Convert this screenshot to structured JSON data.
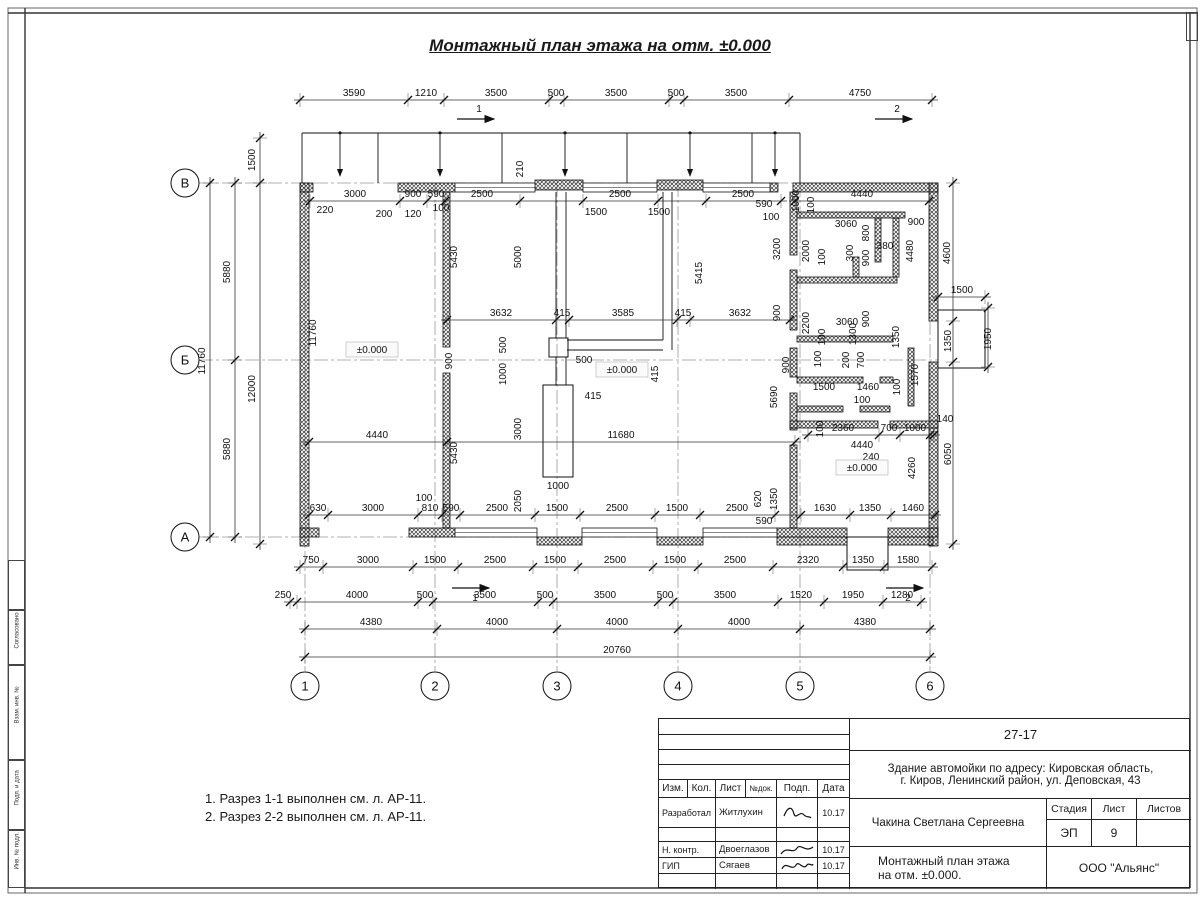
{
  "title": "Монтажный план этажа на отм. ±0.000",
  "notes": [
    "1. Разрез 1-1 выполнен см. л. АР-11.",
    "2. Разрез 2-2 выполнен см. л. АР-11."
  ],
  "title_block": {
    "doc_number": "27-17",
    "project_line1": "Здание автомойки по адресу: Кировская область,",
    "project_line2": "г. Киров, Ленинский район, ул. Деповская, 43",
    "columns": [
      "Изм.",
      "Кол.",
      "Лист",
      "№док.",
      "Подп.",
      "Дата"
    ],
    "rows": [
      {
        "role": "Разработал",
        "name": "Житлухин",
        "date": "10.17"
      },
      {
        "role": "Н. контр.",
        "name": "Двоеглазов",
        "date": "10.17"
      },
      {
        "role": "ГИП",
        "name": "Сягаев",
        "date": "10.17"
      }
    ],
    "author": "Чакина Светлана Сергеевна",
    "stage_label": "Стадия",
    "sheet_label": "Лист",
    "sheets_label": "Листов",
    "stage": "ЭП",
    "sheet_no": "9",
    "sheets_total": "",
    "drawing_name_line1": "Монтажный план этажа",
    "drawing_name_line2": "на отм. ±0.000.",
    "company": "ООО \"Альянс\""
  },
  "left_frame": {
    "labels": [
      "Согласовано",
      "Взам. инв. №",
      "Подп. и дата",
      "Инв. № подл."
    ]
  },
  "plan": {
    "elevation_mark": "±0.000",
    "axes_bottom": [
      {
        "label": "1",
        "x": 305
      },
      {
        "label": "2",
        "x": 435
      },
      {
        "label": "3",
        "x": 557
      },
      {
        "label": "4",
        "x": 678
      },
      {
        "label": "5",
        "x": 800
      },
      {
        "label": "6",
        "x": 930
      }
    ],
    "axes_left": [
      {
        "label": "В",
        "y": 183
      },
      {
        "label": "Б",
        "y": 360
      },
      {
        "label": "А",
        "y": 537
      }
    ],
    "labels": [
      [
        "3590",
        354,
        96
      ],
      [
        "1210",
        426,
        96
      ],
      [
        "3500",
        496,
        96
      ],
      [
        "500",
        556,
        96
      ],
      [
        "3500",
        616,
        96
      ],
      [
        "500",
        676,
        96
      ],
      [
        "3500",
        736,
        96
      ],
      [
        "4750",
        860,
        96
      ],
      [
        "1",
        479,
        112
      ],
      [
        "2",
        897,
        112
      ],
      [
        "1",
        475,
        601
      ],
      [
        "2",
        908,
        601
      ],
      [
        "1500",
        255,
        160,
        1
      ],
      [
        "210",
        523,
        169,
        1
      ],
      [
        "3000",
        355,
        197
      ],
      [
        "900",
        413,
        197
      ],
      [
        "590",
        436,
        197
      ],
      [
        "2500",
        482,
        197
      ],
      [
        "2500",
        620,
        197
      ],
      [
        "2500",
        743,
        197
      ],
      [
        "4440",
        862,
        197
      ],
      [
        "220",
        325,
        213
      ],
      [
        "200",
        384,
        217
      ],
      [
        "120",
        413,
        217
      ],
      [
        "100",
        441,
        211
      ],
      [
        "1500",
        596,
        215
      ],
      [
        "1500",
        659,
        215
      ],
      [
        "590",
        764,
        207
      ],
      [
        "100",
        771,
        220
      ],
      [
        "1000",
        799,
        201,
        1
      ],
      [
        "100",
        814,
        205,
        1
      ],
      [
        "3060",
        846,
        227
      ],
      [
        "800",
        869,
        233,
        1
      ],
      [
        "380",
        885,
        249
      ],
      [
        "900",
        916,
        225
      ],
      [
        "4480",
        913,
        251,
        1
      ],
      [
        "4600",
        950,
        253,
        1
      ],
      [
        "3200",
        780,
        249,
        1
      ],
      [
        "2000",
        809,
        251,
        1
      ],
      [
        "100",
        825,
        257,
        1
      ],
      [
        "300",
        853,
        253,
        1
      ],
      [
        "900",
        869,
        258,
        1
      ],
      [
        "1500",
        962,
        293
      ],
      [
        "1950",
        991,
        339,
        1
      ],
      [
        "1350",
        951,
        341,
        1
      ],
      [
        "1350",
        899,
        337,
        1
      ],
      [
        "1300",
        856,
        334,
        1
      ],
      [
        "100",
        825,
        337,
        1
      ],
      [
        "3060",
        847,
        325
      ],
      [
        "2200",
        809,
        323,
        1
      ],
      [
        "900",
        780,
        313,
        1
      ],
      [
        "900",
        869,
        319,
        1
      ],
      [
        "5415",
        702,
        273,
        1
      ],
      [
        "5690",
        777,
        397,
        1
      ],
      [
        "3632",
        501,
        316
      ],
      [
        "415",
        562,
        316
      ],
      [
        "3585",
        623,
        316
      ],
      [
        "415",
        683,
        316
      ],
      [
        "3632",
        740,
        316
      ],
      [
        "500",
        506,
        345,
        1
      ],
      [
        "900",
        452,
        361,
        1
      ],
      [
        "1000",
        506,
        374,
        1
      ],
      [
        "500",
        584,
        363
      ],
      [
        "415",
        593,
        399
      ],
      [
        "415",
        658,
        374,
        1
      ],
      [
        "±0.000",
        622,
        373,
        0,
        1
      ],
      [
        "±0.000",
        372,
        353,
        0,
        1
      ],
      [
        "11760",
        316,
        333,
        1
      ],
      [
        "5430",
        457,
        257,
        1
      ],
      [
        "5000",
        521,
        257,
        1
      ],
      [
        "5430",
        457,
        453,
        1
      ],
      [
        "3000",
        521,
        429,
        1
      ],
      [
        "4440",
        377,
        438
      ],
      [
        "11680",
        621,
        438
      ],
      [
        "1000",
        558,
        489
      ],
      [
        "2050",
        521,
        501,
        1
      ],
      [
        "1500",
        824,
        390
      ],
      [
        "1460",
        868,
        390
      ],
      [
        "100",
        862,
        403
      ],
      [
        "100",
        900,
        387,
        1
      ],
      [
        "1570",
        918,
        375,
        1
      ],
      [
        "900",
        789,
        365,
        1
      ],
      [
        "100",
        821,
        359,
        1
      ],
      [
        "200",
        849,
        360,
        1
      ],
      [
        "700",
        864,
        360,
        1
      ],
      [
        "2360",
        843,
        431
      ],
      [
        "700",
        889,
        431
      ],
      [
        "1000",
        915,
        431
      ],
      [
        "140",
        945,
        422
      ],
      [
        "4440",
        862,
        448
      ],
      [
        "240",
        871,
        460
      ],
      [
        "±0.000",
        862,
        471,
        0,
        1
      ],
      [
        "4260",
        915,
        468,
        1
      ],
      [
        "6050",
        951,
        454,
        1
      ],
      [
        "100",
        823,
        429,
        1
      ],
      [
        "630",
        318,
        511
      ],
      [
        "3000",
        373,
        511
      ],
      [
        "100",
        424,
        501
      ],
      [
        "810",
        430,
        511
      ],
      [
        "590",
        451,
        511
      ],
      [
        "2500",
        497,
        511
      ],
      [
        "1500",
        557,
        511
      ],
      [
        "2500",
        617,
        511
      ],
      [
        "1500",
        677,
        511
      ],
      [
        "2500",
        737,
        511
      ],
      [
        "590",
        764,
        524
      ],
      [
        "620",
        761,
        499,
        1
      ],
      [
        "1350",
        777,
        499,
        1
      ],
      [
        "1630",
        825,
        511
      ],
      [
        "1350",
        870,
        511
      ],
      [
        "1460",
        913,
        511
      ],
      [
        "750",
        311,
        563
      ],
      [
        "3000",
        368,
        563
      ],
      [
        "1500",
        435,
        563
      ],
      [
        "2500",
        495,
        563
      ],
      [
        "1500",
        555,
        563
      ],
      [
        "2500",
        615,
        563
      ],
      [
        "1500",
        675,
        563
      ],
      [
        "2500",
        735,
        563
      ],
      [
        "2320",
        808,
        563
      ],
      [
        "1350",
        863,
        563
      ],
      [
        "1580",
        908,
        563
      ],
      [
        "250",
        283,
        598
      ],
      [
        "4000",
        357,
        598
      ],
      [
        "500",
        425,
        598
      ],
      [
        "3500",
        485,
        598
      ],
      [
        "500",
        545,
        598
      ],
      [
        "3500",
        605,
        598
      ],
      [
        "500",
        665,
        598
      ],
      [
        "3500",
        725,
        598
      ],
      [
        "1520",
        801,
        598
      ],
      [
        "1950",
        853,
        598
      ],
      [
        "1280",
        902,
        598
      ],
      [
        "4380",
        371,
        625
      ],
      [
        "4000",
        497,
        625
      ],
      [
        "4000",
        617,
        625
      ],
      [
        "4000",
        739,
        625
      ],
      [
        "4380",
        865,
        625
      ],
      [
        "20760",
        617,
        653
      ],
      [
        "5880",
        230,
        272,
        1
      ],
      [
        "5880",
        230,
        449,
        1
      ],
      [
        "11760",
        205,
        361,
        1
      ],
      [
        "12000",
        255,
        389,
        1
      ]
    ]
  }
}
